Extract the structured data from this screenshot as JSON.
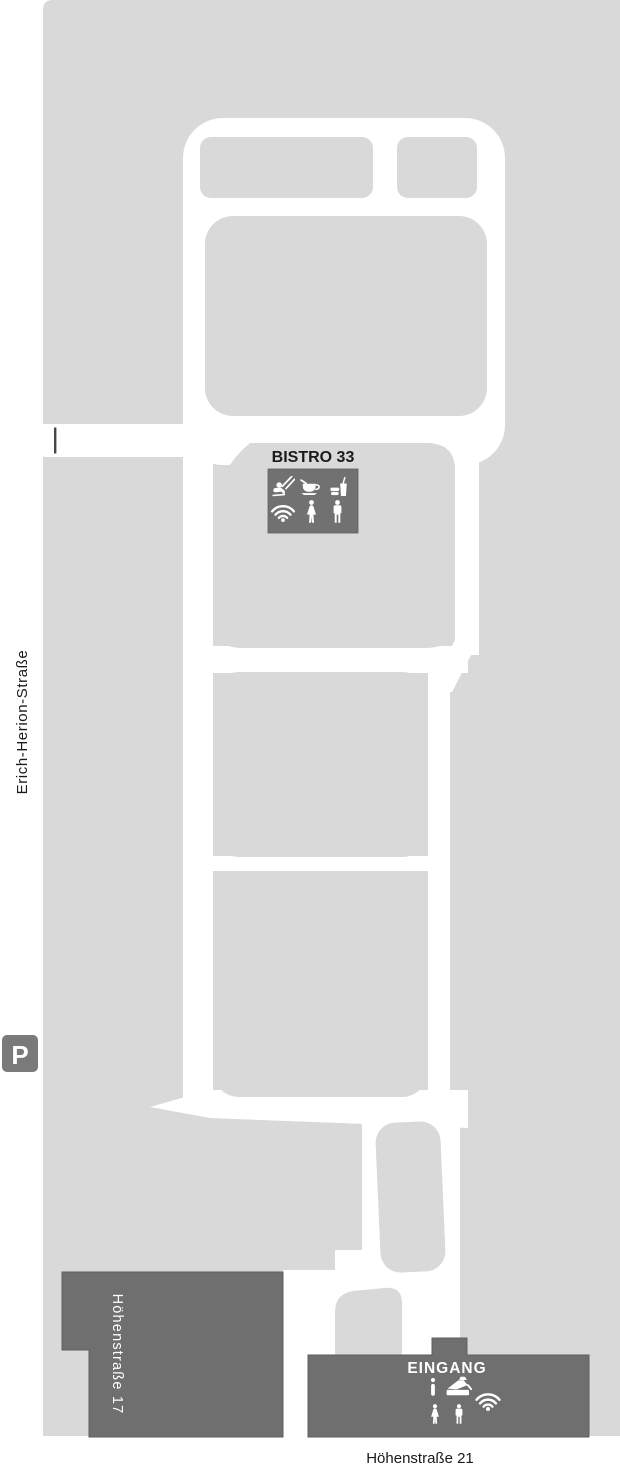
{
  "map": {
    "streets": {
      "left_vertical": "Erich-Herion-Straße",
      "bottom": "Höhenstraße 21"
    },
    "buildings": {
      "neighbor": {
        "label": "Höhenstraße 17"
      },
      "entrance": {
        "label": "EINGANG",
        "amenities": [
          "info-icon",
          "cash-register-icon",
          "wifi-icon",
          "women-wc-icon",
          "men-wc-icon"
        ]
      },
      "bistro": {
        "label": "BISTRO 33",
        "amenities": [
          "playground-swing-icon",
          "coffee-icon",
          "snack-drink-icon",
          "wifi-icon",
          "women-wc-icon",
          "men-wc-icon"
        ]
      }
    },
    "parking": {
      "label": "P"
    },
    "colors": {
      "page_bg": "#ffffff",
      "area_fill": "#d9d9d9",
      "path_fill": "#ffffff",
      "building_fill": "#6f6f6f",
      "building_stroke": "#5e5e5e",
      "bistro_box_fill": "#717171",
      "parking_fill": "#7a7a7a",
      "marker_fill": "#474747",
      "label_dark": "#1a1a1a",
      "label_light": "#ffffff"
    }
  }
}
